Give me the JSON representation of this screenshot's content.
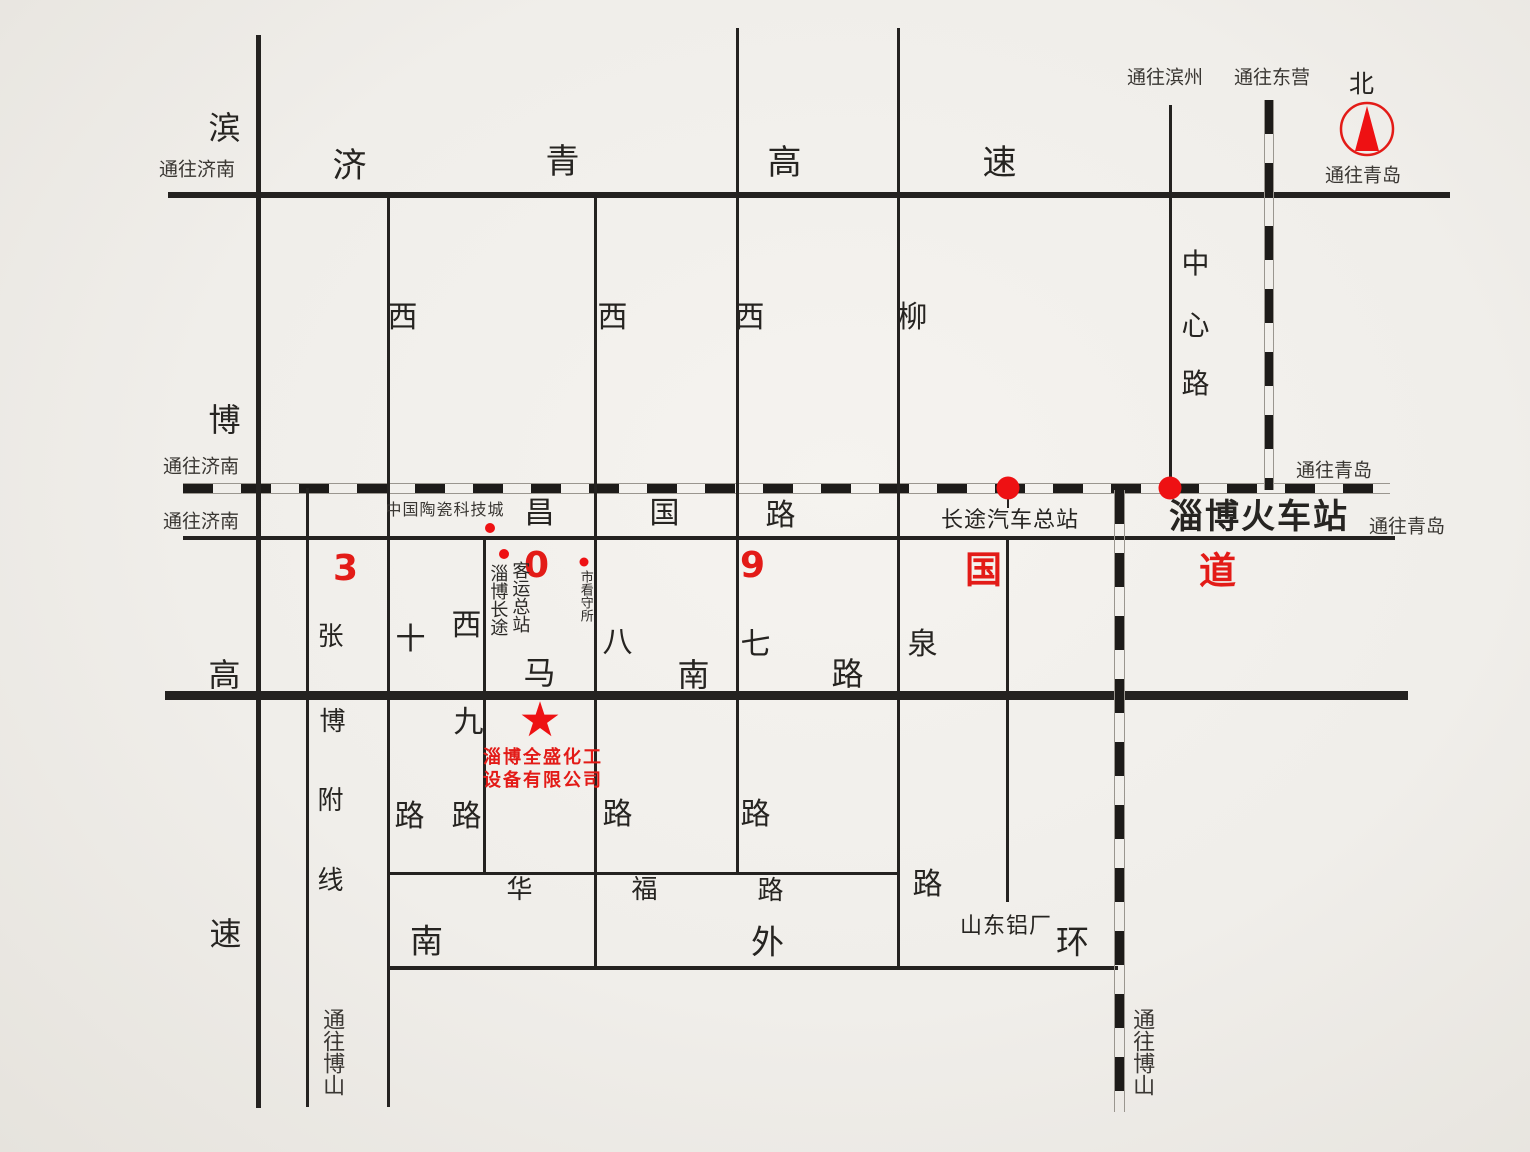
{
  "colors": {
    "red": "#e31b17",
    "ink": "#242220",
    "bg": "#f0eeea"
  },
  "compass": {
    "north": "北"
  },
  "edge_labels": {
    "to_jinan_expwy": "通往济南",
    "to_jinan_rail": "通往济南",
    "to_jinan_changguo": "通往济南",
    "to_binzhou": "通往滨州",
    "to_dongying": "通往东营",
    "to_qingdao_compass": "通往青岛",
    "to_qingdao_rail": "通往青岛",
    "to_qingdao_changguo": "通往青岛",
    "to_boshan_west": "通往博山",
    "to_boshan_east": "通往博山"
  },
  "roads": {
    "jiqing_expressway": [
      "济",
      "青",
      "高",
      "速"
    ],
    "binbo_expressway": [
      "滨",
      "博",
      "高",
      "速"
    ],
    "changguo_road": [
      "昌",
      "国",
      "路"
    ],
    "g309_highway": [
      "3",
      "0",
      "9",
      "国",
      "道"
    ],
    "manan_road": [
      "马",
      "南",
      "路"
    ],
    "huafu_road": [
      "华",
      "福",
      "路"
    ],
    "south_outer_ring": [
      "南",
      "外",
      "环"
    ],
    "zhangbo_branch": [
      "张",
      "博",
      "附",
      "线"
    ],
    "xishi_road": [
      "西",
      "十",
      "路"
    ],
    "xijiu_road": [
      "西",
      "九",
      "路"
    ],
    "xiba_road": [
      "西",
      "八",
      "路"
    ],
    "xiqi_road": [
      "西",
      "七",
      "路"
    ],
    "liuquan_road": [
      "柳",
      "泉",
      "路"
    ],
    "zhongxin_road": [
      "中",
      "心",
      "路"
    ]
  },
  "pois": {
    "ceramics_city": "中国陶瓷科技城",
    "coach_terminal_col1": "淄博长途",
    "coach_terminal_col2": "客运总站",
    "detention_house": "市看守所",
    "bus_terminal": "长途汽车总站",
    "railway_station": "淄博火车站",
    "aluminum_plant": "山东铝厂",
    "company_name_line1": "淄博全盛化工",
    "company_name_line2": "设备有限公司"
  }
}
